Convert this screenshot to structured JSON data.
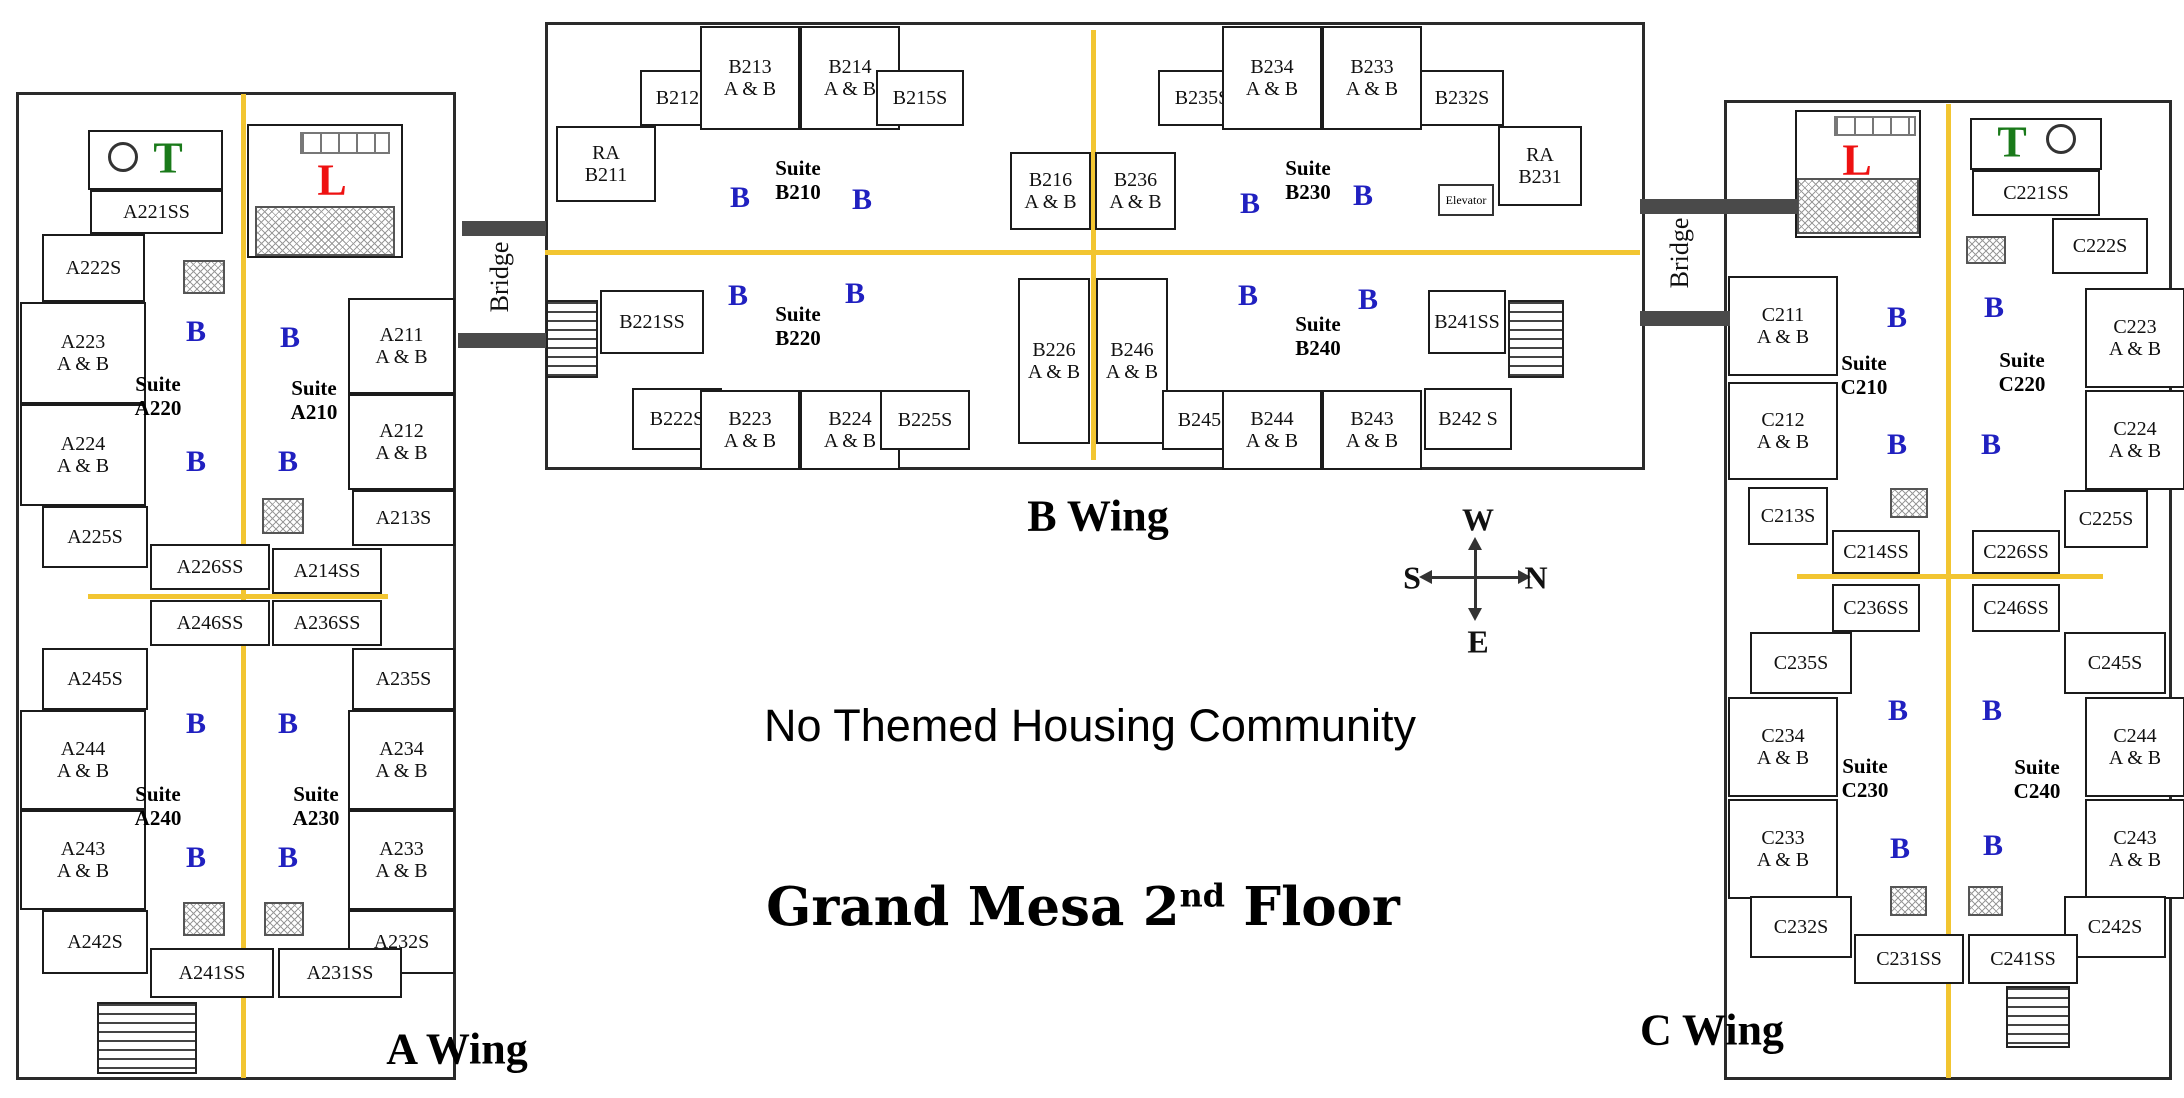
{
  "banner": {
    "text": "No Themed Housing Community"
  },
  "title": {
    "prefix": "Grand Mesa 2",
    "sup": "nd",
    "suffix": " Floor"
  },
  "compass": {
    "up": "W",
    "left": "S",
    "right": "N",
    "down": "E"
  },
  "bath_letter": "B",
  "elevator": {
    "label": "Elevator",
    "rect": [
      1438,
      184,
      56,
      32
    ]
  },
  "colors": {
    "corridor": "#F2C531",
    "bath": "#2020C0",
    "letter_T": "#1A7A1A",
    "letter_L": "#EE1111",
    "bridge_bar": "#4A4A4A"
  },
  "corridors": [
    [
      241,
      94,
      5,
      984
    ],
    [
      88,
      594,
      300,
      5
    ],
    [
      545,
      250,
      1095,
      5
    ],
    [
      1091,
      30,
      5,
      430
    ],
    [
      1946,
      104,
      5,
      974
    ],
    [
      1797,
      574,
      306,
      5
    ]
  ],
  "stairs": [
    [
      97,
      1002,
      100,
      72
    ],
    [
      546,
      300,
      52,
      78
    ],
    [
      1508,
      300,
      56,
      78
    ],
    [
      2006,
      986,
      64,
      62
    ]
  ],
  "hatches": [
    [
      255,
      206,
      140,
      50
    ],
    [
      183,
      260,
      42,
      34
    ],
    [
      262,
      498,
      42,
      36
    ],
    [
      183,
      902,
      42,
      34
    ],
    [
      264,
      902,
      40,
      34
    ],
    [
      1797,
      178,
      122,
      56
    ],
    [
      1966,
      236,
      40,
      28
    ],
    [
      1890,
      488,
      38,
      30
    ],
    [
      1890,
      886,
      37,
      30
    ],
    [
      1968,
      886,
      35,
      30
    ]
  ],
  "windows": [
    [
      300,
      132,
      90,
      22
    ],
    [
      1834,
      116,
      82,
      20
    ]
  ],
  "circles": [
    [
      108,
      142,
      30
    ],
    [
      2046,
      124,
      30
    ]
  ],
  "bridges": [
    {
      "label": "Bridge",
      "bars": [
        [
          462,
          221,
          84,
          15
        ],
        [
          458,
          333,
          88,
          15
        ]
      ],
      "label_x": 500,
      "label_y": 277
    },
    {
      "label": "Bridge",
      "bars": [
        [
          1640,
          199,
          158,
          15
        ],
        [
          1640,
          311,
          90,
          15
        ]
      ],
      "label_x": 1680,
      "label_y": 253
    }
  ],
  "wings": [
    {
      "id": "A",
      "label": "A Wing",
      "label_x": 457,
      "label_y": 1049,
      "rooms": [
        {
          "t": "",
          "n": "A-utility",
          "r": [
            88,
            130,
            135,
            60
          ]
        },
        {
          "t": "",
          "n": "A-lounge",
          "r": [
            247,
            124,
            156,
            134
          ]
        },
        {
          "t": "A221SS",
          "r": [
            90,
            190,
            133,
            44
          ]
        },
        {
          "t": "A222S",
          "r": [
            42,
            234,
            103,
            68
          ]
        },
        {
          "t": "A223\nA & B",
          "r": [
            20,
            302,
            126,
            102
          ]
        },
        {
          "t": "A224\nA & B",
          "r": [
            20,
            404,
            126,
            102
          ]
        },
        {
          "t": "A225S",
          "r": [
            42,
            506,
            106,
            62
          ]
        },
        {
          "t": "A226SS",
          "r": [
            150,
            544,
            120,
            46
          ]
        },
        {
          "t": "A211\nA & B",
          "r": [
            348,
            298,
            107,
            96
          ]
        },
        {
          "t": "A212\nA & B",
          "r": [
            348,
            394,
            107,
            96
          ]
        },
        {
          "t": "A213S",
          "r": [
            352,
            490,
            103,
            56
          ]
        },
        {
          "t": "A214SS",
          "r": [
            272,
            548,
            110,
            46
          ]
        },
        {
          "t": "A246SS",
          "r": [
            150,
            600,
            120,
            46
          ]
        },
        {
          "t": "A236SS",
          "r": [
            272,
            600,
            110,
            46
          ]
        },
        {
          "t": "A245S",
          "r": [
            42,
            648,
            106,
            62
          ]
        },
        {
          "t": "A235S",
          "r": [
            352,
            648,
            103,
            62
          ]
        },
        {
          "t": "A244\nA & B",
          "r": [
            20,
            710,
            126,
            100
          ]
        },
        {
          "t": "A234\nA & B",
          "r": [
            348,
            710,
            107,
            100
          ]
        },
        {
          "t": "A243\nA & B",
          "r": [
            20,
            810,
            126,
            100
          ]
        },
        {
          "t": "A233\nA & B",
          "r": [
            348,
            810,
            107,
            100
          ]
        },
        {
          "t": "A242S",
          "r": [
            42,
            910,
            106,
            64
          ]
        },
        {
          "t": "A232S",
          "r": [
            348,
            910,
            107,
            64
          ]
        },
        {
          "t": "A241SS",
          "r": [
            150,
            948,
            124,
            50
          ]
        },
        {
          "t": "A231SS",
          "r": [
            278,
            948,
            124,
            50
          ]
        }
      ],
      "suites": [
        {
          "t": "Suite\nA220",
          "x": 158,
          "y": 396
        },
        {
          "t": "Suite\nA210",
          "x": 314,
          "y": 400
        },
        {
          "t": "Suite\nA240",
          "x": 158,
          "y": 806
        },
        {
          "t": "Suite\nA230",
          "x": 316,
          "y": 806
        }
      ],
      "baths": [
        [
          196,
          332
        ],
        [
          290,
          338
        ],
        [
          196,
          462
        ],
        [
          288,
          462
        ],
        [
          196,
          724
        ],
        [
          288,
          724
        ],
        [
          196,
          858
        ],
        [
          288,
          858
        ]
      ],
      "letters": [
        {
          "t": "T",
          "color": "letter_T",
          "x": 168,
          "y": 158
        },
        {
          "t": "L",
          "color": "letter_L",
          "x": 332,
          "y": 180
        }
      ]
    },
    {
      "id": "B",
      "label": "B Wing",
      "label_x": 1098,
      "label_y": 516,
      "rooms": [
        {
          "t": "RA\nB211",
          "r": [
            556,
            126,
            100,
            76
          ]
        },
        {
          "t": "B212S",
          "r": [
            640,
            70,
            86,
            56
          ]
        },
        {
          "t": "B213\nA & B",
          "r": [
            700,
            26,
            100,
            104
          ]
        },
        {
          "t": "B214\nA & B",
          "r": [
            800,
            26,
            100,
            104
          ]
        },
        {
          "t": "B215S",
          "r": [
            876,
            70,
            88,
            56
          ]
        },
        {
          "t": "B216\nA & B",
          "r": [
            1010,
            152,
            81,
            78
          ]
        },
        {
          "t": "B236\nA & B",
          "r": [
            1095,
            152,
            81,
            78
          ]
        },
        {
          "t": "B235S",
          "r": [
            1158,
            70,
            88,
            56
          ]
        },
        {
          "t": "B234\nA & B",
          "r": [
            1222,
            26,
            100,
            104
          ]
        },
        {
          "t": "B233\nA & B",
          "r": [
            1322,
            26,
            100,
            104
          ]
        },
        {
          "t": "B232S",
          "r": [
            1420,
            70,
            84,
            56
          ]
        },
        {
          "t": "RA\nB231",
          "r": [
            1498,
            126,
            84,
            80
          ]
        },
        {
          "t": "B221SS",
          "r": [
            600,
            290,
            104,
            64
          ]
        },
        {
          "t": "B222S",
          "r": [
            632,
            388,
            90,
            62
          ]
        },
        {
          "t": "B223\nA & B",
          "r": [
            700,
            390,
            100,
            80
          ]
        },
        {
          "t": "B224\nA & B",
          "r": [
            800,
            390,
            100,
            80
          ]
        },
        {
          "t": "B225S",
          "r": [
            880,
            390,
            90,
            60
          ]
        },
        {
          "t": "B226\nA & B",
          "r": [
            1018,
            278,
            72,
            166
          ]
        },
        {
          "t": "B246\nA & B",
          "r": [
            1096,
            278,
            72,
            166
          ]
        },
        {
          "t": "B245S",
          "r": [
            1162,
            390,
            86,
            60
          ]
        },
        {
          "t": "B244\nA & B",
          "r": [
            1222,
            390,
            100,
            80
          ]
        },
        {
          "t": "B243\nA & B",
          "r": [
            1322,
            390,
            100,
            80
          ]
        },
        {
          "t": "B242 S",
          "r": [
            1424,
            388,
            88,
            62
          ]
        },
        {
          "t": "B241SS",
          "r": [
            1428,
            290,
            78,
            64
          ]
        }
      ],
      "suites": [
        {
          "t": "Suite\nB210",
          "x": 798,
          "y": 180
        },
        {
          "t": "Suite\nB230",
          "x": 1308,
          "y": 180
        },
        {
          "t": "Suite\nB220",
          "x": 798,
          "y": 326
        },
        {
          "t": "Suite\nB240",
          "x": 1318,
          "y": 336
        }
      ],
      "baths": [
        [
          740,
          198
        ],
        [
          862,
          200
        ],
        [
          1250,
          204
        ],
        [
          1363,
          196
        ],
        [
          738,
          296
        ],
        [
          855,
          294
        ],
        [
          1248,
          296
        ],
        [
          1368,
          300
        ]
      ],
      "letters": []
    },
    {
      "id": "C",
      "label": "C Wing",
      "label_x": 1712,
      "label_y": 1030,
      "rooms": [
        {
          "t": "",
          "n": "C-lounge",
          "r": [
            1795,
            110,
            126,
            128
          ]
        },
        {
          "t": "",
          "n": "C-utility",
          "r": [
            1970,
            118,
            132,
            52
          ]
        },
        {
          "t": "C221SS",
          "r": [
            1972,
            170,
            128,
            46
          ]
        },
        {
          "t": "C222S",
          "r": [
            2052,
            218,
            96,
            56
          ]
        },
        {
          "t": "C211\nA & B",
          "r": [
            1728,
            276,
            110,
            100
          ]
        },
        {
          "t": "C223\nA & B",
          "r": [
            2085,
            288,
            100,
            100
          ]
        },
        {
          "t": "C212\nA & B",
          "r": [
            1728,
            382,
            110,
            98
          ]
        },
        {
          "t": "C224\nA & B",
          "r": [
            2085,
            390,
            100,
            100
          ]
        },
        {
          "t": "C213S",
          "r": [
            1748,
            487,
            80,
            58
          ]
        },
        {
          "t": "C225S",
          "r": [
            2064,
            490,
            84,
            58
          ]
        },
        {
          "t": "C214SS",
          "r": [
            1832,
            530,
            88,
            44
          ]
        },
        {
          "t": "C226SS",
          "r": [
            1972,
            530,
            88,
            44
          ]
        },
        {
          "t": "C236SS",
          "r": [
            1832,
            584,
            88,
            48
          ]
        },
        {
          "t": "C246SS",
          "r": [
            1972,
            584,
            88,
            48
          ]
        },
        {
          "t": "C235S",
          "r": [
            1750,
            632,
            102,
            62
          ]
        },
        {
          "t": "C245S",
          "r": [
            2064,
            632,
            102,
            62
          ]
        },
        {
          "t": "C234\nA & B",
          "r": [
            1728,
            697,
            110,
            100
          ]
        },
        {
          "t": "C244\nA & B",
          "r": [
            2085,
            697,
            100,
            100
          ]
        },
        {
          "t": "C233\nA & B",
          "r": [
            1728,
            799,
            110,
            100
          ]
        },
        {
          "t": "C243\nA & B",
          "r": [
            2085,
            799,
            100,
            100
          ]
        },
        {
          "t": "C232S",
          "r": [
            1750,
            896,
            102,
            62
          ]
        },
        {
          "t": "C242S",
          "r": [
            2064,
            896,
            102,
            62
          ]
        },
        {
          "t": "C231SS",
          "r": [
            1854,
            934,
            110,
            50
          ]
        },
        {
          "t": "C241SS",
          "r": [
            1968,
            934,
            110,
            50
          ]
        }
      ],
      "suites": [
        {
          "t": "Suite\nC210",
          "x": 1864,
          "y": 375
        },
        {
          "t": "Suite\nC220",
          "x": 2022,
          "y": 372
        },
        {
          "t": "Suite\nC230",
          "x": 1865,
          "y": 778
        },
        {
          "t": "Suite\nC240",
          "x": 2037,
          "y": 779
        }
      ],
      "baths": [
        [
          1897,
          318
        ],
        [
          1994,
          308
        ],
        [
          1897,
          445
        ],
        [
          1991,
          445
        ],
        [
          1898,
          711
        ],
        [
          1992,
          711
        ],
        [
          1900,
          849
        ],
        [
          1993,
          846
        ]
      ],
      "letters": [
        {
          "t": "L",
          "color": "letter_L",
          "x": 1857,
          "y": 160
        },
        {
          "t": "T",
          "color": "letter_T",
          "x": 2012,
          "y": 142
        }
      ]
    }
  ]
}
